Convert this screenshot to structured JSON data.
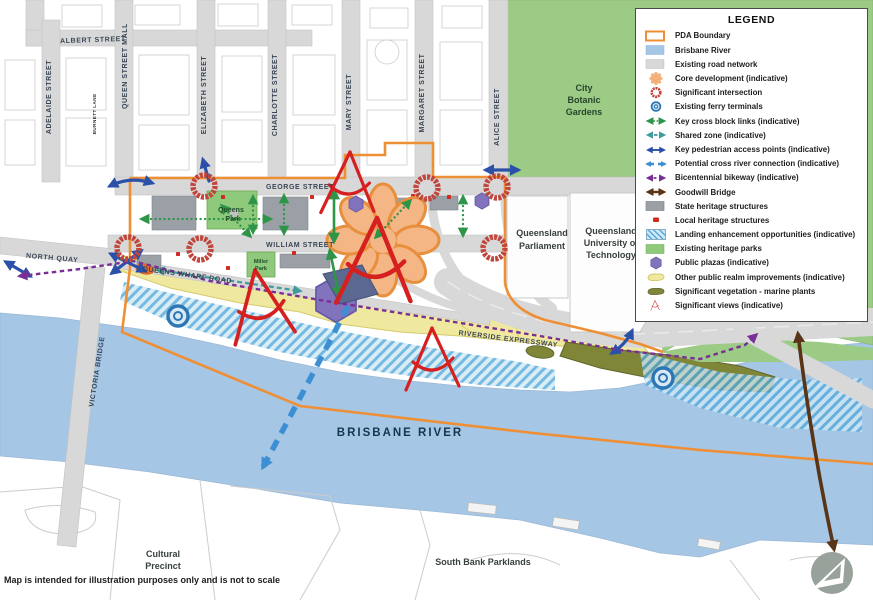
{
  "map": {
    "disclaimer": "Map is intended for illustration purposes only and is not to scale",
    "streets": {
      "albert": "ALBERT STREET",
      "adelaide": "ADELAIDE STREET",
      "burnett": "BURNETT LANE",
      "queen_mall": "QUEEN STREET MALL",
      "elizabeth": "ELIZABETH STREET",
      "charlotte": "CHARLOTTE STREET",
      "mary": "MARY STREET",
      "margaret": "MARGARET STREET",
      "alice": "ALICE STREET",
      "george": "GEORGE STREET",
      "william": "WILLIAM STREET",
      "north_quay": "NORTH QUAY",
      "queens_wharf": "QUEENS WHARF ROAD",
      "victoria_bridge": "VICTORIA BRIDGE",
      "riverside": "RIVERSIDE EXPRESSWAY"
    },
    "places": {
      "queens_park_l1": "Queens",
      "queens_park_l2": "Park",
      "miller_park_l1": "Miller",
      "miller_park_l2": "Park",
      "botanic_l1": "City",
      "botanic_l2": "Botanic",
      "botanic_l3": "Gardens",
      "parliament_l1": "Queensland",
      "parliament_l2": "Parliament",
      "qut_l1": "Queensland",
      "qut_l2": "University of",
      "qut_l3": "Technology",
      "river": "BRISBANE RIVER",
      "cultural_l1": "Cultural",
      "cultural_l2": "Precinct",
      "south_bank": "South Bank Parklands"
    }
  },
  "legend": {
    "title": "LEGEND",
    "items": [
      "PDA Boundary",
      "Brisbane River",
      "Existing road network",
      "Core development (indicative)",
      "Significant intersection",
      "Existing ferry terminals",
      "Key cross block links (indicative)",
      "Shared zone (indicative)",
      "Key pedestrian access points (indicative)",
      "Potential cross river connection (indicative)",
      "Bicentennial bikeway (indicative)",
      "Goodwill Bridge",
      "State heritage structures",
      "Local heritage structures",
      "Landing enhancement opportunities (indicative)",
      "Existing heritage parks",
      "Public plazas (indicative)",
      "Other public realm improvements (indicative)",
      "Significant vegetation - marine plants",
      "Significant views (indicative)"
    ]
  },
  "colors": {
    "pda_boundary": "#ee8f35",
    "river": "#a5c6e5",
    "road": "#d8d8d8",
    "heritage_park": "#9bcb84",
    "core_development": "#f4b685",
    "significant_intersection": "#c0463c",
    "ferry_terminal": "#2d76b5",
    "cross_block_link": "#2e9447",
    "shared_zone": "#3f9c9c",
    "pedestrian_access": "#2b50a8",
    "cross_river_connection": "#3d8fd4",
    "bicentennial_bikeway": "#7a2f96",
    "goodwill_bridge": "#5a3417",
    "state_heritage": "#9aa0a6",
    "local_heritage": "#cf2b20",
    "landing_enhancement": "#58a8dc",
    "public_plaza": "#8174bd",
    "public_realm": "#efe9a0",
    "vegetation": "#7f8637",
    "significant_views": "#d62020"
  }
}
